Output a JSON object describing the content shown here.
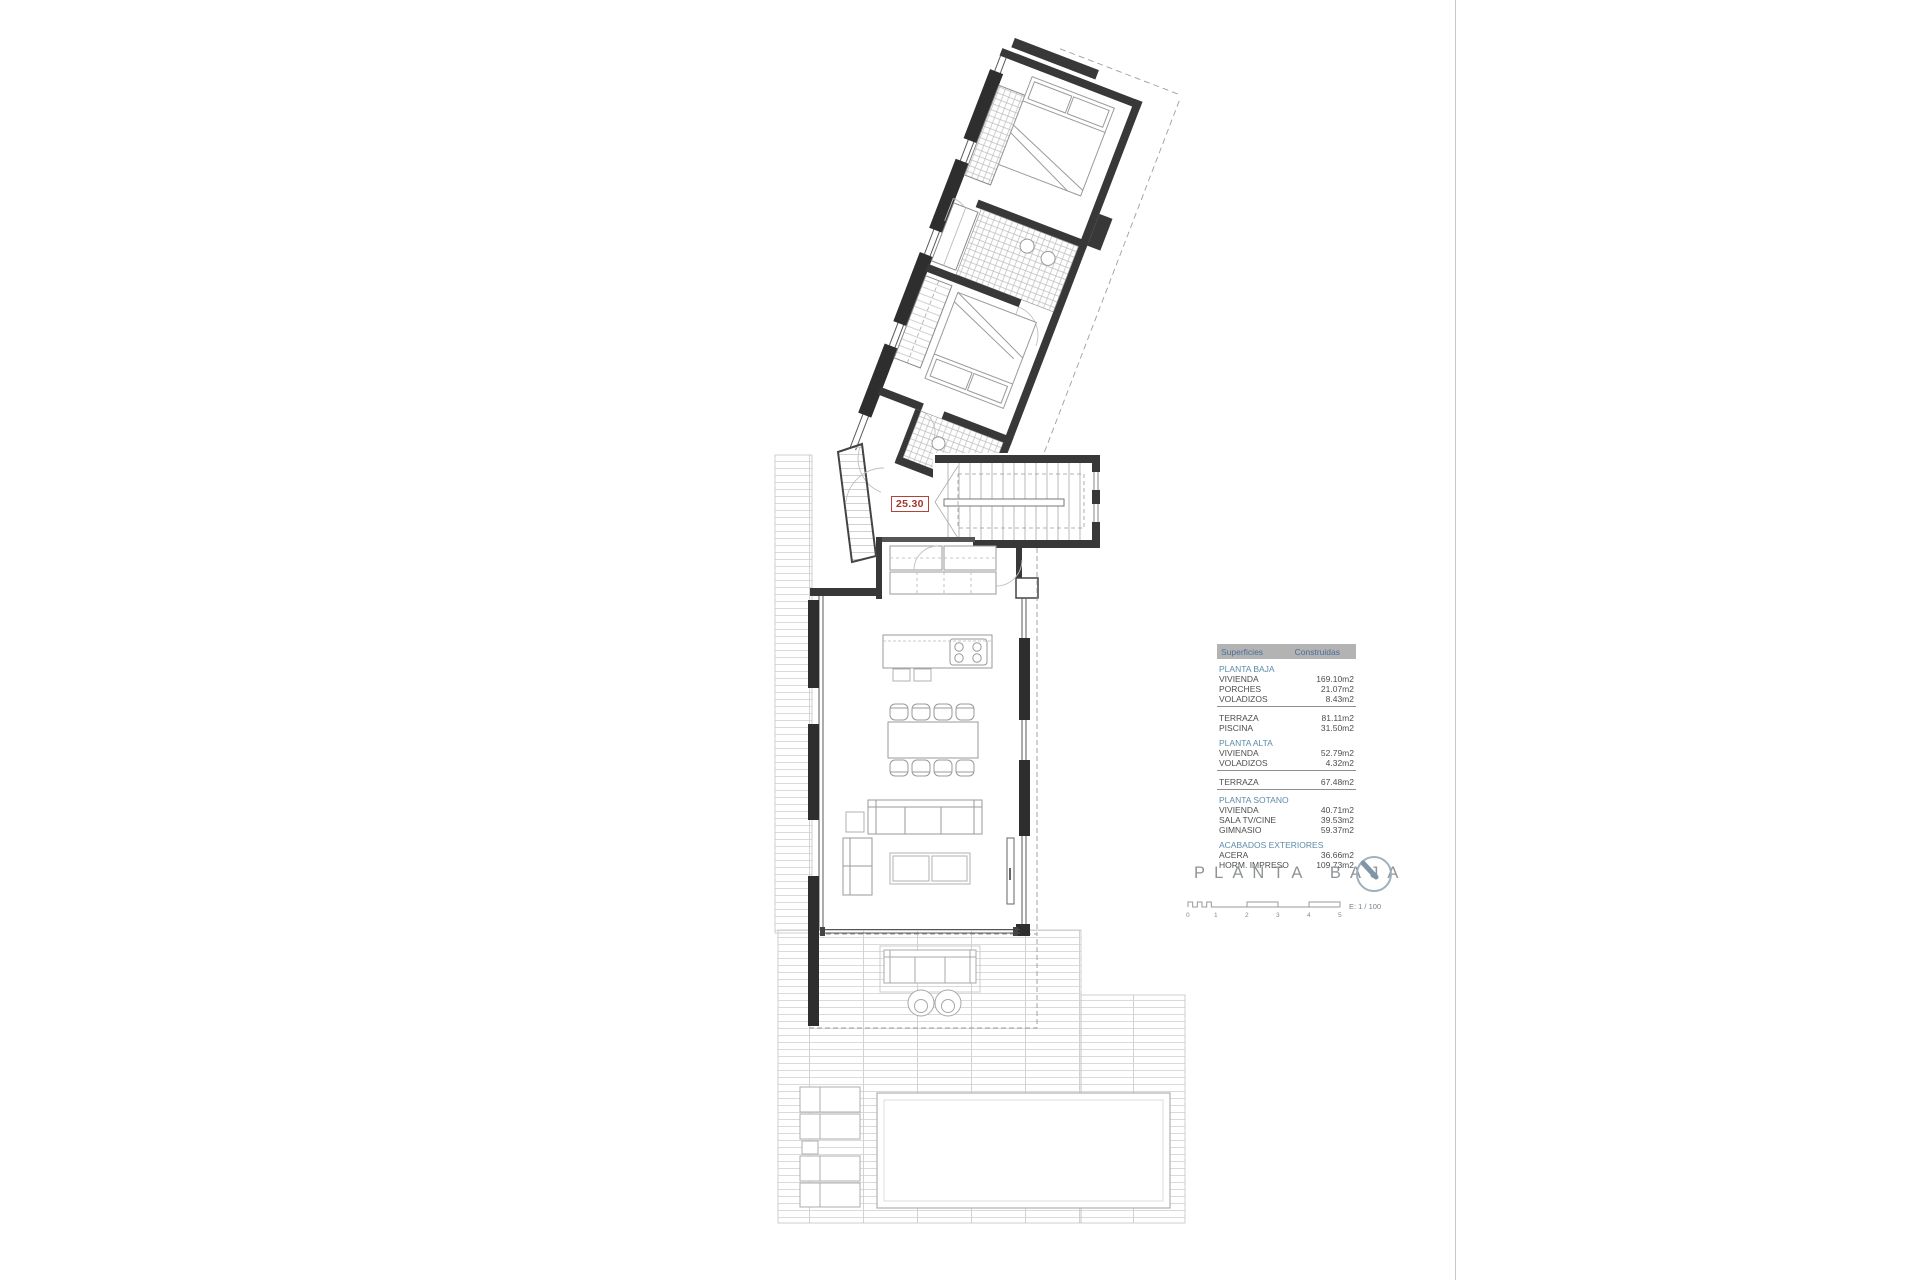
{
  "plan": {
    "dimension_label": "25.30"
  },
  "title": {
    "text": "PLANTA BAJA"
  },
  "scalebar": {
    "ticks": [
      "0",
      "1",
      "2",
      "3",
      "4",
      "5"
    ],
    "ratio": "E: 1 / 100"
  },
  "table": {
    "header": {
      "col1": "Superficies",
      "col2": "Construidas"
    },
    "rows": [
      {
        "label": "PLANTA BAJA",
        "value": ""
      },
      {
        "label": "VIVIENDA",
        "value": "169.10m2"
      },
      {
        "label": "PORCHES",
        "value": "21.07m2"
      },
      {
        "label": "VOLADIZOS",
        "value": "8.43m2"
      },
      {
        "label": "TERRAZA",
        "value": "81.11m2"
      },
      {
        "label": "PISCINA",
        "value": "31.50m2"
      },
      {
        "label": "PLANTA ALTA",
        "value": ""
      },
      {
        "label": "VIVIENDA",
        "value": "52.79m2"
      },
      {
        "label": "VOLADIZOS",
        "value": "4.32m2"
      },
      {
        "label": "TERRAZA",
        "value": "67.48m2"
      },
      {
        "label": "PLANTA SOTANO",
        "value": ""
      },
      {
        "label": "VIVIENDA",
        "value": "40.71m2"
      },
      {
        "label": "SALA TV/CINE",
        "value": "39.53m2"
      },
      {
        "label": "GIMNASIO",
        "value": "59.37m2"
      },
      {
        "label": "ACABADOS EXTERIORES",
        "value": ""
      },
      {
        "label": "ACERA",
        "value": "36.66m2"
      },
      {
        "label": "HORM. IMPRESO",
        "value": "109.73m2"
      }
    ]
  },
  "colors": {
    "accent_red": "#A93E32",
    "table_header_bg": "#B3B3B3",
    "table_header_text": "#4A6E99",
    "section_text": "#5B8BA8",
    "wall": "#383838",
    "compass": "#92A5B4"
  }
}
